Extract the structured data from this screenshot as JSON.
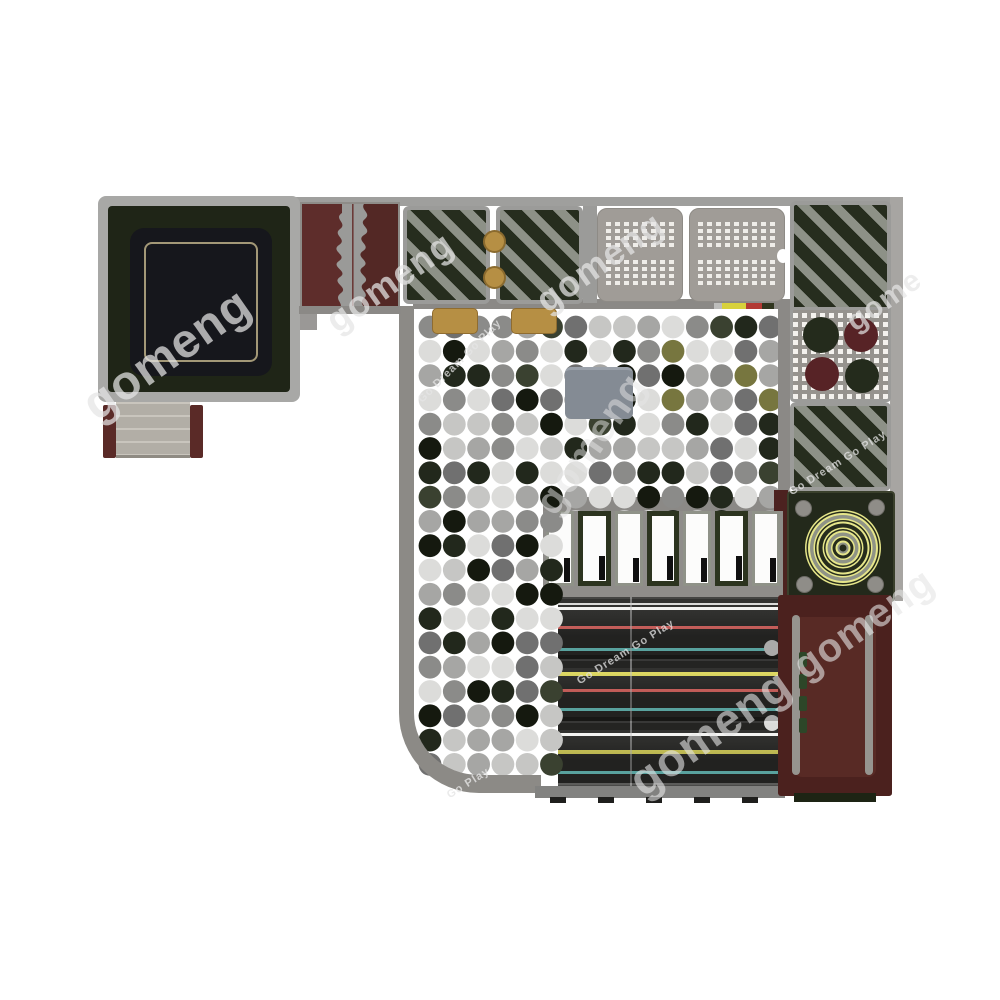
{
  "scene": {
    "type": "playground-equipment-top-view",
    "background": "#ffffff"
  },
  "watermarks": [
    {
      "text": "gomeng",
      "x": 88,
      "y": 382,
      "size": 48,
      "angle": -35,
      "opacity": 0.72
    },
    {
      "text": "gomeng",
      "x": 330,
      "y": 303,
      "size": 36,
      "angle": -35,
      "opacity": 0.72
    },
    {
      "text": "gomeng",
      "x": 540,
      "y": 283,
      "size": 36,
      "angle": -35,
      "opacity": 0.72
    },
    {
      "text": "gome",
      "x": 850,
      "y": 308,
      "size": 30,
      "angle": -35,
      "opacity": 0.7
    },
    {
      "text": "gomeng",
      "x": 545,
      "y": 488,
      "size": 40,
      "angle": -55,
      "opacity": 0.5
    },
    {
      "text": "Go Dream Go Play",
      "x": 420,
      "y": 395,
      "size": 11,
      "angle": -45,
      "opacity": 0.75
    },
    {
      "text": "Go Dream Go Play",
      "x": 790,
      "y": 487,
      "size": 11,
      "angle": -32,
      "opacity": 0.75
    },
    {
      "text": "gomeng",
      "x": 798,
      "y": 648,
      "size": 40,
      "angle": -35,
      "opacity": 0.6
    },
    {
      "text": "gomeng",
      "x": 634,
      "y": 758,
      "size": 46,
      "angle": -35,
      "opacity": 0.6
    },
    {
      "text": "Go Dream Go Play",
      "x": 578,
      "y": 676,
      "size": 11,
      "angle": -32,
      "opacity": 0.75
    },
    {
      "text": "Go Play",
      "x": 448,
      "y": 790,
      "size": 11,
      "angle": -32,
      "opacity": 0.8
    }
  ],
  "ball_pit": {
    "seed": 11,
    "cols": 15,
    "rows": 19,
    "x0": 430,
    "y0": 327,
    "spacing": 24.3,
    "r": 11.4,
    "palette": [
      {
        "c": "#dcdcda",
        "w": 3
      },
      {
        "c": "#c6c6c4",
        "w": 3
      },
      {
        "c": "#a6a6a4",
        "w": 3
      },
      {
        "c": "#8b8b89",
        "w": 2
      },
      {
        "c": "#707070",
        "w": 2
      },
      {
        "c": "#22281c",
        "w": 3
      },
      {
        "c": "#3a4130",
        "w": 1
      },
      {
        "c": "#15190f",
        "w": 2
      }
    ],
    "olive": "#77763f",
    "fg_col": 5,
    "fg_from_row": 8
  },
  "slides": {
    "lane_colors": [
      "#f4f4f2",
      "#e26a66",
      "#72cfcb",
      "#ddd75e"
    ],
    "stripes": [
      {
        "o": 6,
        "h": 2,
        "c": "#d9d9d7"
      },
      {
        "o": 10,
        "h": 3,
        "c": "#f4f4f2"
      },
      {
        "o": 29,
        "h": 3,
        "c": "#e26a66"
      },
      {
        "o": 51,
        "h": 3,
        "c": "#72cfcb"
      },
      {
        "o": 58,
        "h": 13,
        "c": "#1d1d1b"
      },
      {
        "o": 63,
        "h": 2,
        "c": "#969694"
      },
      {
        "o": 75,
        "h": 4,
        "c": "#ddd75e"
      },
      {
        "o": 92,
        "h": 3,
        "c": "#e26a66"
      },
      {
        "o": 111,
        "h": 3,
        "c": "#72cfcb"
      },
      {
        "o": 120,
        "h": 13,
        "c": "#1d1d1b"
      },
      {
        "o": 125,
        "h": 2,
        "c": "#d9d9d7"
      },
      {
        "o": 136,
        "h": 3,
        "c": "#f4f4f2"
      },
      {
        "o": 153,
        "h": 4,
        "c": "#ddd75e"
      },
      {
        "o": 174,
        "h": 3,
        "c": "#72cfcb"
      },
      {
        "o": 186,
        "h": 7,
        "c": "#454543"
      }
    ]
  },
  "slide_entrances": {
    "count": 7,
    "frame_colors": {
      "gray": "#8f9288",
      "green": "#2c341f"
    },
    "notch_color": "#101010"
  },
  "target": {
    "cx": 54,
    "cy": 55,
    "ring_colors": {
      "yellow": "#e6e68a",
      "dark": "#262c1c",
      "gray": "#8f9386"
    },
    "rings": [
      {
        "r": 38,
        "c": "#e6e68a"
      },
      {
        "r": 36.5,
        "c": "#262c1c"
      },
      {
        "r": 35,
        "c": "#e6e68a"
      },
      {
        "r": 33,
        "c": "#8f9386"
      },
      {
        "r": 29.5,
        "c": "#e6e68a"
      },
      {
        "r": 28,
        "c": "#262c1c"
      },
      {
        "r": 26.5,
        "c": "#e6e68a"
      },
      {
        "r": 24.5,
        "c": "#262c1c"
      },
      {
        "r": 20.5,
        "c": "#e6e68a"
      },
      {
        "r": 19,
        "c": "#262c1c"
      },
      {
        "r": 17.5,
        "c": "#e6e68a"
      },
      {
        "r": 15.5,
        "c": "#8f9386"
      },
      {
        "r": 12,
        "c": "#e6e68a"
      },
      {
        "r": 10.5,
        "c": "#262c1c"
      },
      {
        "r": 7.5,
        "c": "#e6e68a"
      },
      {
        "r": 5.5,
        "c": "#8f9386"
      },
      {
        "r": 3.5,
        "c": "#262c1c"
      }
    ]
  },
  "circle_panel": {
    "circles": [
      {
        "cx": 28,
        "cy": 25,
        "r": 18,
        "c": "#242b1c"
      },
      {
        "cx": 68,
        "cy": 25,
        "r": 17,
        "c": "#572326"
      },
      {
        "cx": 29,
        "cy": 64,
        "r": 17,
        "c": "#572326"
      },
      {
        "cx": 69,
        "cy": 66,
        "r": 17,
        "c": "#242b1c"
      }
    ]
  },
  "right_platform": {
    "tab_count": 4,
    "tab_color": "#2d4628"
  },
  "colors": {
    "frame_gray": "#9f9f9d",
    "panel_green_dark": "#262d1e",
    "panel_stripe_gray": "#8d9187",
    "maroon": "#4b211e",
    "tan": "#b68f44",
    "target_yellow": "#e6e68a",
    "slide_red": "#e26a66",
    "slide_cyan": "#72cfcb",
    "slide_yellow": "#ddd75e"
  }
}
